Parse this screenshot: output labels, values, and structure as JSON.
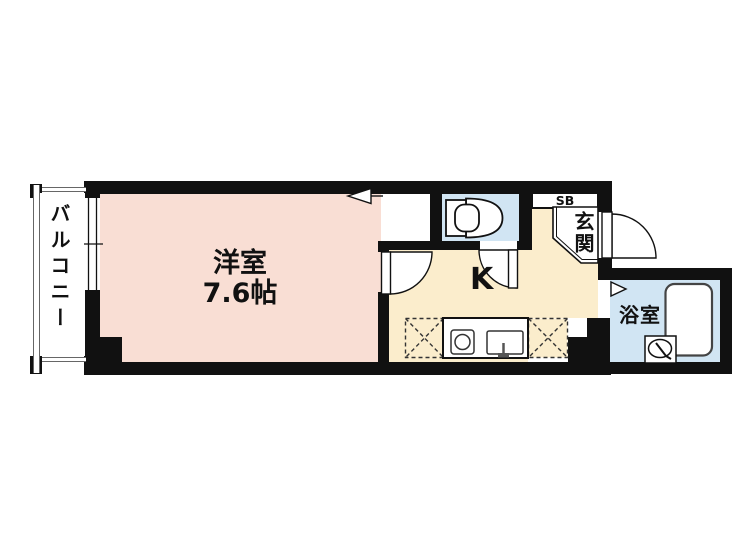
{
  "plan": {
    "labels": {
      "balcony": "バルコニー",
      "room": "洋室",
      "room_size": "7.6帖",
      "kitchen": "K",
      "shoe_box": "SB",
      "entrance": "玄関",
      "bathroom": "浴室"
    },
    "icons": [
      "toilet-icon",
      "bathtub-icon",
      "washbasin-icon",
      "stove-burner-icon",
      "kitchen-sink-icon",
      "door-swing-arc",
      "folding-door-marker",
      "opening-flag-marker",
      "window-double-line",
      "dashed-appliance-space"
    ],
    "colors": {
      "wall": "#111111",
      "room_fill": "#f9ded4",
      "kitchen_fill": "#fbedcc",
      "water_fill": "#d1e5f3",
      "fixture_line": "#333333",
      "rail_line": "#666666",
      "background": "#ffffff",
      "text": "#111111"
    }
  }
}
